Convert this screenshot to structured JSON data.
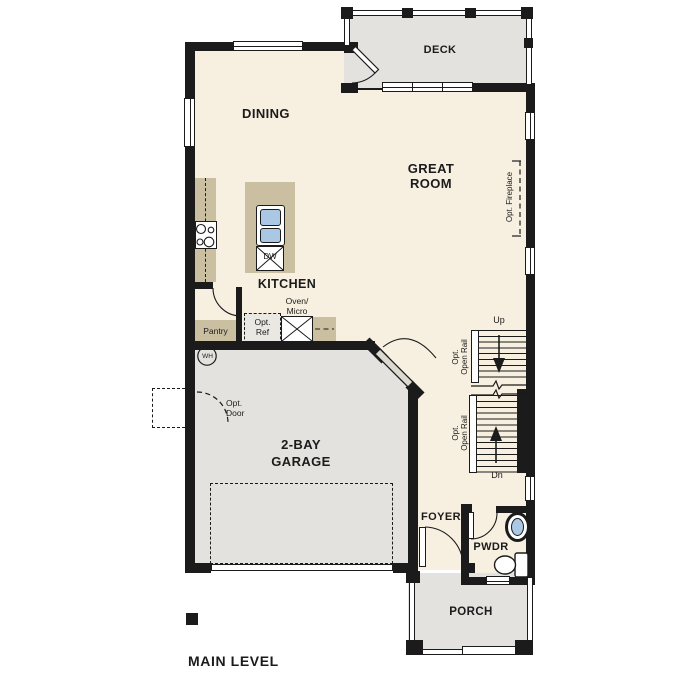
{
  "plan": {
    "title": "MAIN LEVEL",
    "rooms": {
      "dining": "DINING",
      "kitchen": "KITCHEN",
      "great_room": [
        "GREAT",
        "ROOM"
      ],
      "garage": [
        "2-BAY",
        "GARAGE"
      ],
      "deck": "DECK",
      "porch": "PORCH",
      "foyer": "FOYER",
      "powder": "PWDR",
      "pantry": "Pantry"
    },
    "fixtures": {
      "dishwasher": "DW",
      "water_heater": "WH"
    },
    "annotations": {
      "opt_ref": [
        "Opt.",
        "Ref"
      ],
      "oven_micro": [
        "Oven/",
        "Micro"
      ],
      "opt_door": [
        "Opt.",
        "Door"
      ],
      "opt_fireplace": "Opt. Fireplace",
      "open_rail": [
        "Opt.",
        "Open Rail"
      ],
      "stairs_up": "Up",
      "stairs_down": "Dn"
    },
    "colors": {
      "bg": "#ffffff",
      "floor": "#f7f0e1",
      "outdoor": "#e3e2df",
      "counter": "#cbbfa2",
      "wall": "#1b1b1b",
      "fixture-blue": "#aac8e4",
      "optional-fill": "#eae8e3",
      "text": "#1b1b1b"
    }
  }
}
